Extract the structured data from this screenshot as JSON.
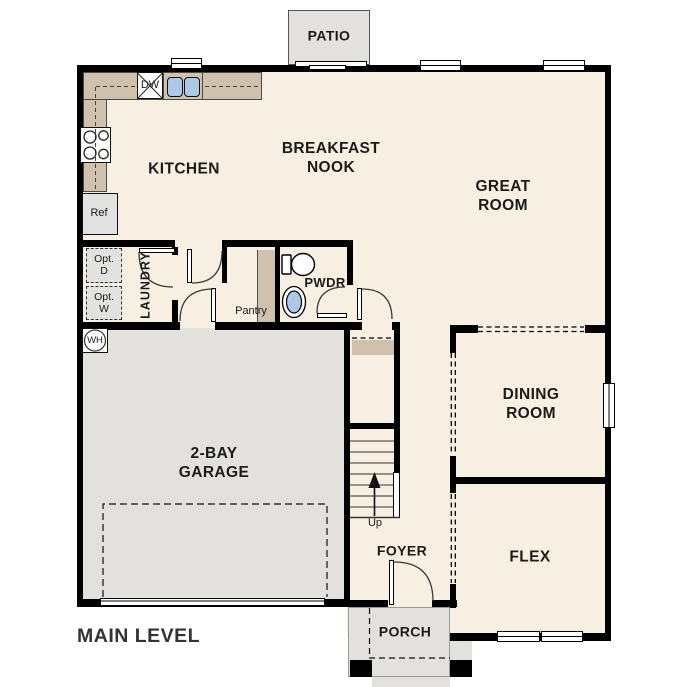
{
  "title": "MAIN LEVEL",
  "rooms": {
    "patio": "PATIO",
    "kitchen": "KITCHEN",
    "breakfast_nook": "BREAKFAST\nNOOK",
    "great_room": "GREAT\nROOM",
    "dining_room": "DINING\nROOM",
    "flex": "FLEX",
    "garage": "2-BAY\nGARAGE",
    "foyer": "FOYER",
    "porch": "PORCH",
    "laundry": "LAUNDRY",
    "pantry": "Pantry",
    "powder": "PWDR"
  },
  "fixtures": {
    "dishwasher": "DW",
    "refrigerator": "Ref",
    "opt_dryer": "Opt.\nD",
    "opt_washer": "Opt.\nW",
    "water_heater": "WH",
    "stairs_direction": "Up"
  },
  "colors": {
    "wall": "#000000",
    "floor": "#f7efe1",
    "concrete": "#e2e1de",
    "counter": "#cfc1ab",
    "fixture_blue": "#abc8e6"
  }
}
